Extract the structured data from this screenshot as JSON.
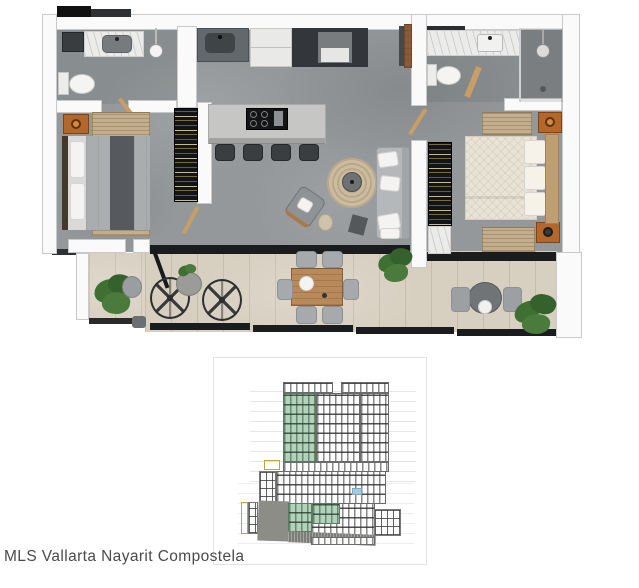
{
  "caption": "MLS Vallarta Nayarit Compostela",
  "palette": {
    "wall": "#fafafa",
    "wall_edge": "#c9c9c9",
    "concrete_floor": "#94989a",
    "terrace_floor": "#d7cfc0",
    "wood": "#b8895a",
    "accent_orange": "#b4672a",
    "closet_black": "#141414",
    "island_gray": "#c6c6c4",
    "sofa_gray": "#b5b8ba",
    "bed_gray": "#a9adb0",
    "bed_cream": "#e9e2d6",
    "rug_tan": "#c2ad8d",
    "plant_green": "#3f6f33",
    "track_black": "#1a1c1e",
    "marble": "#ebebe9",
    "elevation_green": "#b0d3ba",
    "elevation_gray": "#8d8d88",
    "caption_text": "#4a4a4a"
  },
  "floor_plan": {
    "label": "2-bedroom apartment top-down 3D render",
    "rooms": [
      "bathroom-1",
      "bedroom-1",
      "kitchen",
      "living-dining",
      "bathroom-2",
      "bedroom-2",
      "terrace"
    ]
  },
  "elevation_diagram": {
    "label": "building section-elevation drawing",
    "tower_floor_rows": 7,
    "highlighted_green_columns": 1,
    "podium_floor_rows": 3,
    "lower_floor_rows": 3
  }
}
